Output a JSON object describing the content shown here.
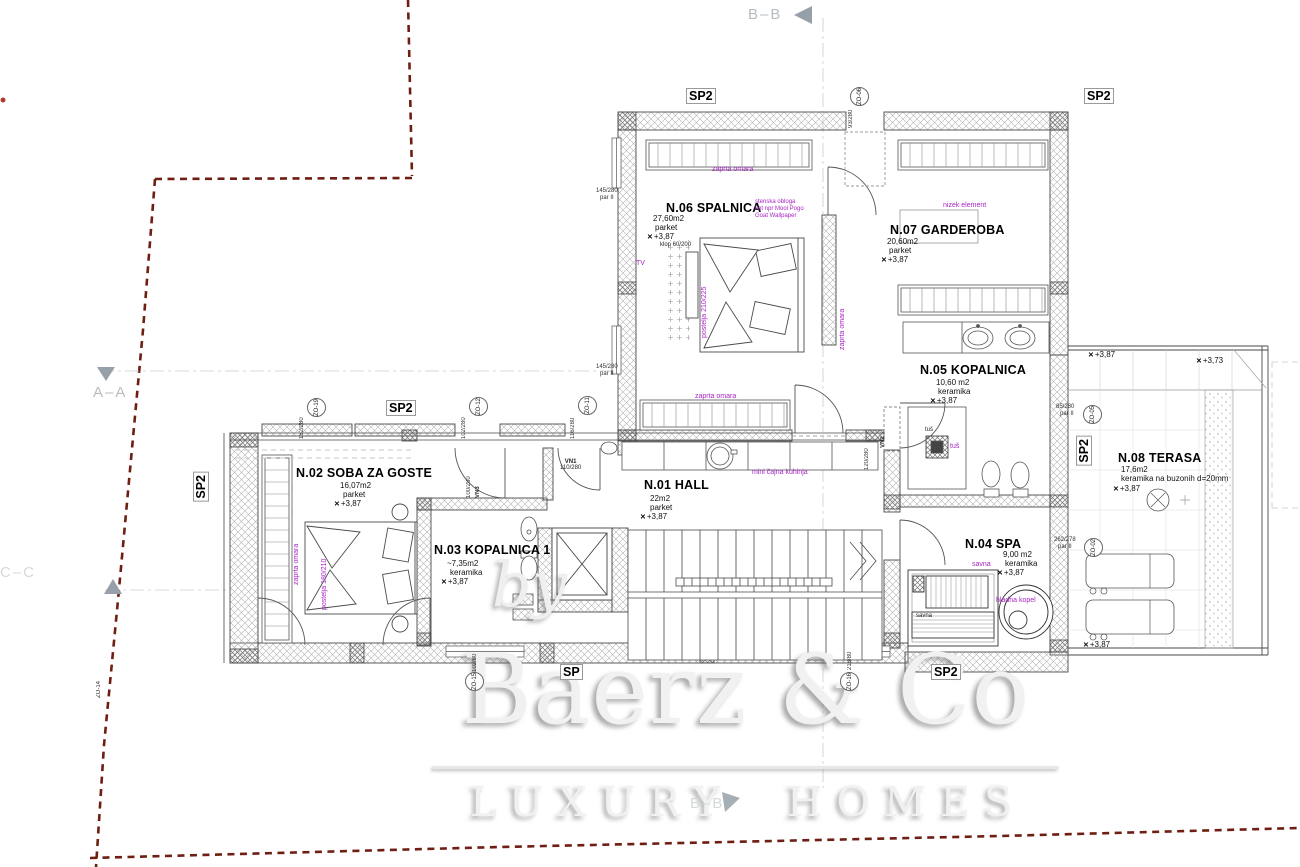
{
  "branding": {
    "by": "by",
    "name": "Baerz & Co",
    "tagline": "LUXURY HOMES"
  },
  "sections": {
    "top": "B–B",
    "bottom": "B–B",
    "left": "A–A",
    "left_lower": "C–C"
  },
  "rooms": [
    {
      "name": "N.01 HALL",
      "area": "22m2",
      "floor": "parket",
      "level": "+3,87"
    },
    {
      "name": "N.02 SOBA ZA GOSTE",
      "area": "16,07m2",
      "floor": "parket",
      "level": "+3,87"
    },
    {
      "name": "N.03 KOPALNICA 1",
      "area": "~7,35m2",
      "floor": "keramika",
      "level": "+3,87"
    },
    {
      "name": "N.04 SPA",
      "area": "9,00 m2",
      "floor": "keramika",
      "level": "+3,87"
    },
    {
      "name": "N.05 KOPALNICA",
      "area": "10,60 m2",
      "floor": "keramika",
      "level": "+3,87"
    },
    {
      "name": "N.06 SPALNICA",
      "area": "27,60m2",
      "floor": "parket",
      "level": "+3,87"
    },
    {
      "name": "N.07 GARDEROBA",
      "area": "20,60m2",
      "floor": "parket",
      "level": "+3,87"
    },
    {
      "name": "N.08 TERASA",
      "area": "17,6m2",
      "floor": "keramika na buzonih d=20mm",
      "level": "+3,87"
    }
  ],
  "wall_labels": {
    "sp2": "SP2",
    "sp": "SP"
  },
  "levels": {
    "t1": "+3,87",
    "t2": "+3,73",
    "t3": "+3,87"
  },
  "icons": {
    "level_mark": "✕"
  },
  "notes_purple": {
    "closet": "zaprta omara",
    "bed_master": "postelja 210/225",
    "bed_guest": "postelja 180/210",
    "tv": "TV",
    "wallpaper_1": "stenska obloga",
    "wallpaper_2": "kot npr Mool Pogo",
    "wallpaper_3": "Goat Wallpaper",
    "low_element": "nizek element",
    "tea_kitchen": "mini čajna kuhinja",
    "shower": "tuš",
    "sauna": "savna",
    "cold_bath": "hladna kopel"
  },
  "notes_black": {
    "bench": "klop 60/200",
    "shower": "tuš",
    "sauna": "savna"
  },
  "doors": {
    "vn1": "VN1",
    "vn1_dim": "110/280",
    "vn2": "VN2",
    "vn2_dim": "120/280",
    "vn3": "VN3",
    "vn3_dim": "100/280"
  },
  "tags": {
    "zo06": "ZO-06",
    "zo06_dim": "93/280",
    "zo19": "ZO-19",
    "zo19_dim": "152/280",
    "zo12": "ZO-12",
    "zo12_dim": "102/280",
    "zo11": "ZO-11",
    "zo11_dim": "116/280",
    "zo05": "ZO-05",
    "zo05_dim": "85/280",
    "zo02": "ZO-02",
    "zo02_dim": "262/278",
    "zo15": "ZO-15",
    "zo15_dim": "102/80",
    "zo16": "ZO-16",
    "zo16_dim": "218/80",
    "zo14": "ZO-14",
    "par": "par II",
    "win_dim": "145/280"
  }
}
